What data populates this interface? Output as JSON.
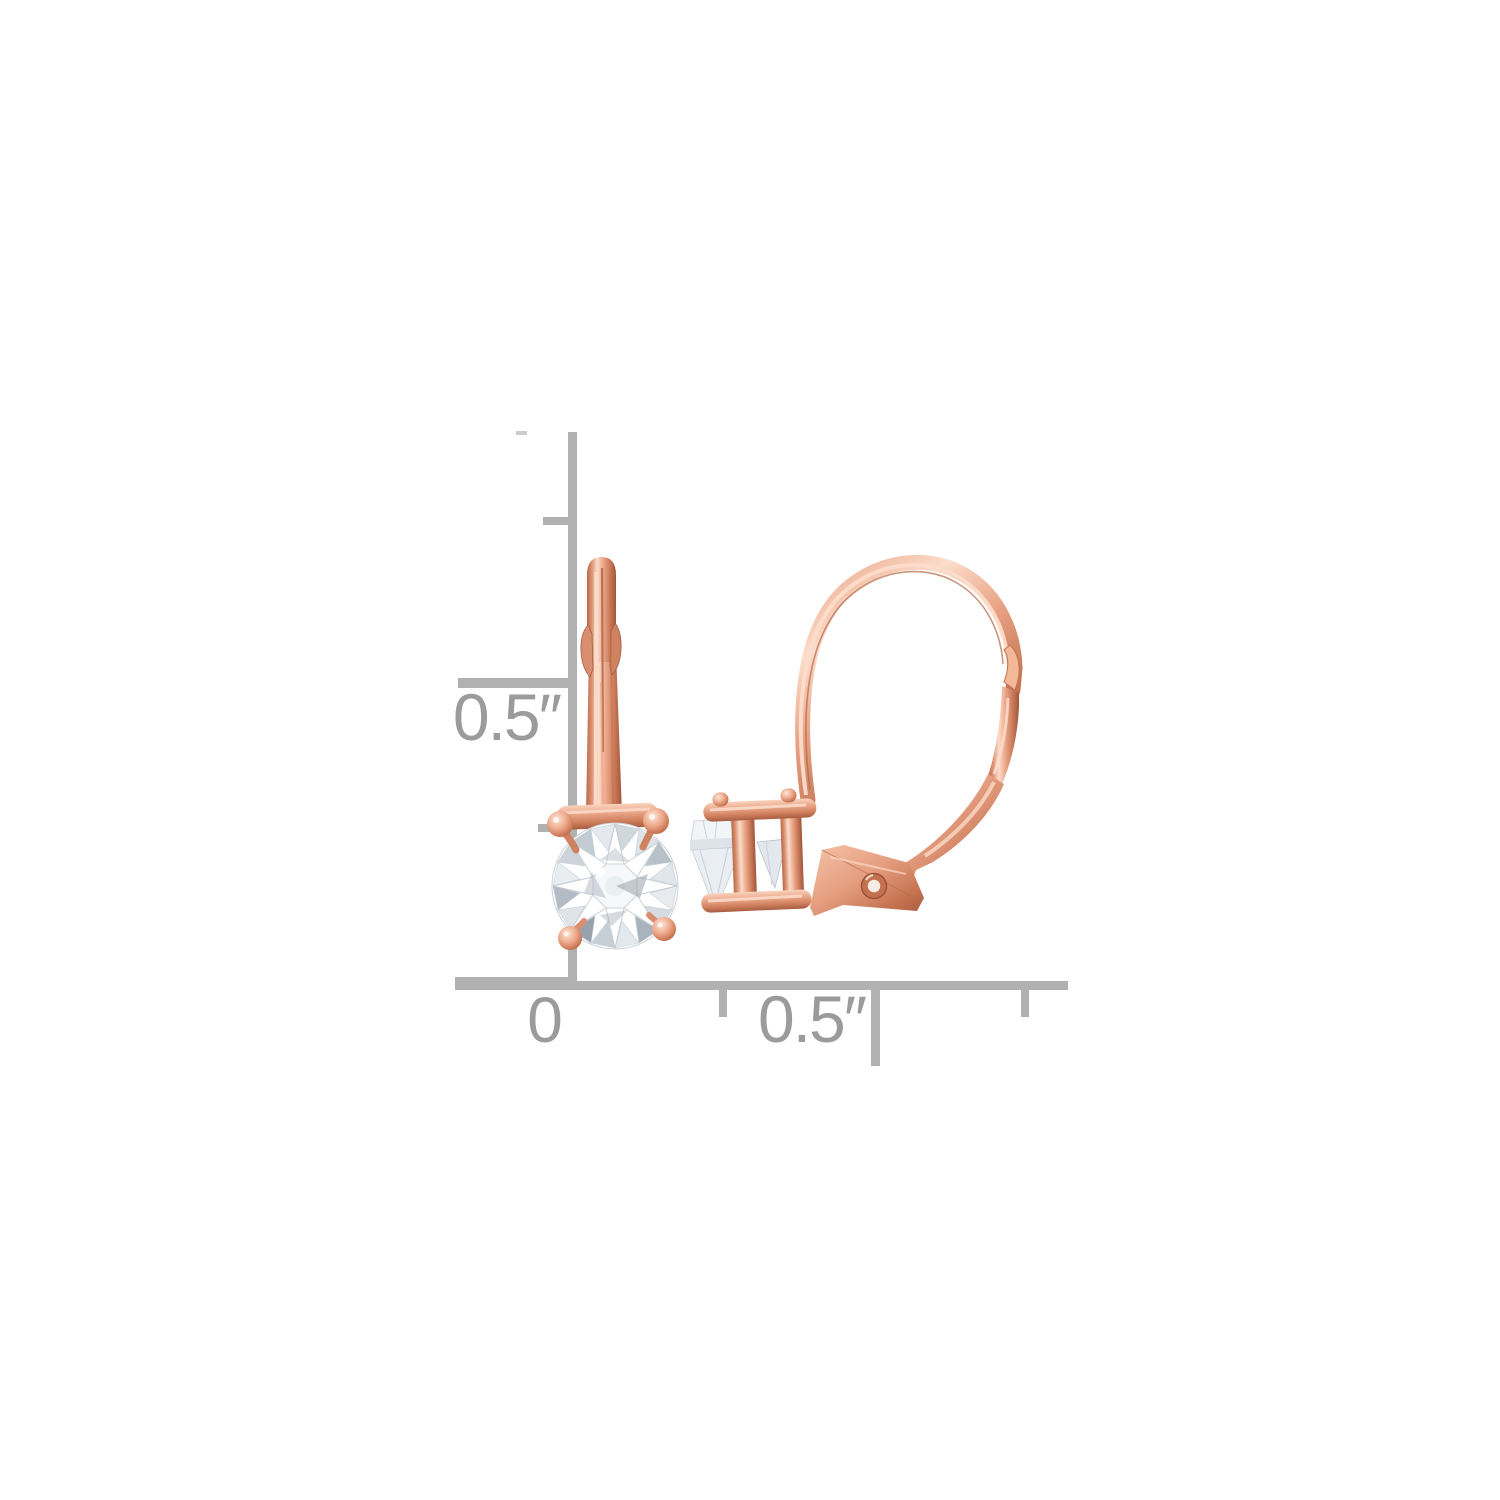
{
  "ruler": {
    "line_color": "#b1b1b1",
    "faint_tick_color": "#cbcbcb",
    "label_color": "#9b9b9b",
    "vertical": {
      "half_inch_label": "0.5″"
    },
    "horizontal": {
      "zero_label": "0",
      "half_inch_label": "0.5″"
    }
  },
  "jewelry": {
    "metal": "rose gold",
    "metal_base_color": "#e59e80",
    "metal_highlight_color": "#fcdccb",
    "metal_shadow_color": "#c4714f",
    "metal_deep_color": "#a0563a",
    "stone_color": "#ffffff",
    "stone_facet_light": "#eef1f4",
    "stone_facet_mid": "#d9dfe4",
    "stone_facet_dark": "#aab4bd"
  }
}
